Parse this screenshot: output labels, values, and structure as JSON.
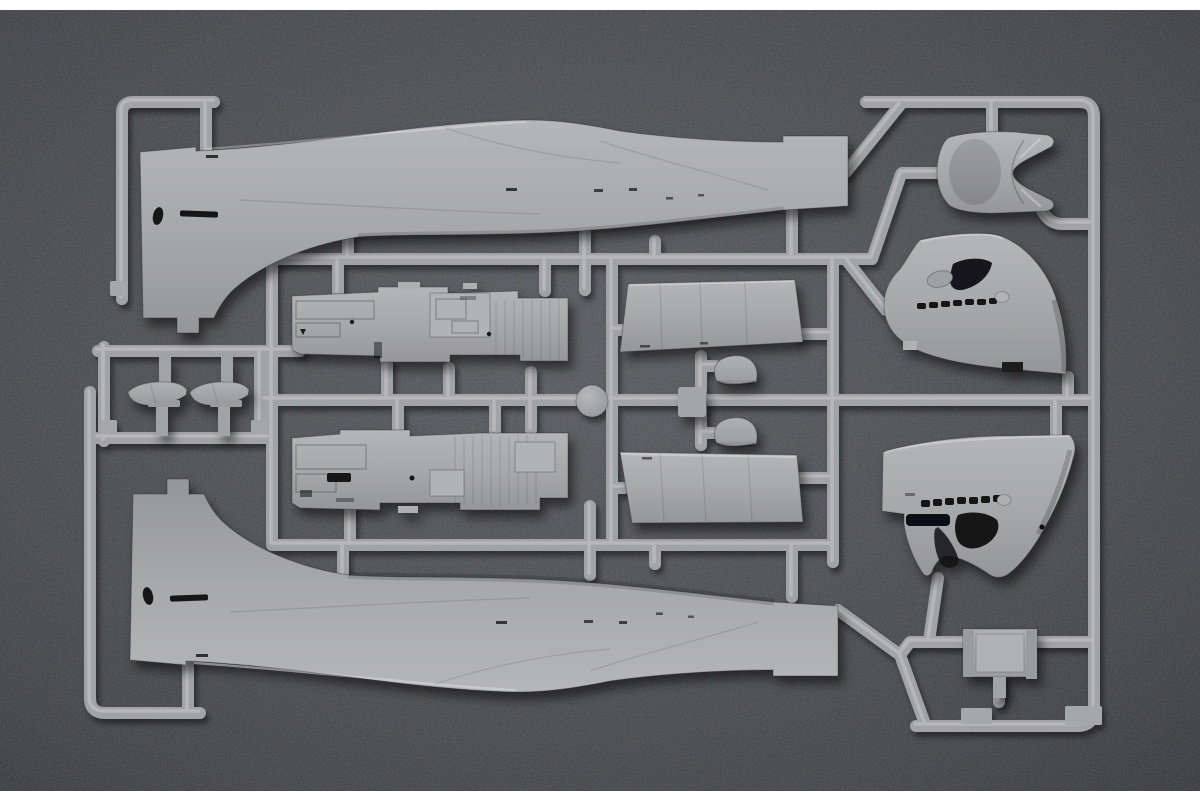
{
  "scene": {
    "description": "Macro product photograph of a grey injection-moulded plastic model aircraft sprue",
    "alt": "Light grey plastic model-kit sprue frame holding two large fuselage halves, two cockpit sidewall floor frames, two flap panels, two engine cowling side panels with rows of exhaust ports, a cowl-flap saddle section, two small intake fairings, two small seat fairings, an access hatch and a round moulding pad, photographed on a dark speckled grey surface with white strips at the top and bottom edges",
    "colors": {
      "backdrop": "#4b4c50",
      "backdrop_highlight": "#595a5f",
      "backdrop_shadow": "#38393d",
      "plastic": "#a6a7a9",
      "plastic_highlight": "#bdbec1",
      "plastic_shadow": "#8e8f92",
      "recess": "#151517",
      "border_strips": "#ffffff"
    },
    "border_strip_top_px": 10,
    "border_strip_bottom_px": 9
  },
  "parts": [
    {
      "id": "fuselage-half-upper",
      "label": "Fuselage half, left side"
    },
    {
      "id": "fuselage-half-lower",
      "label": "Fuselage half, right side"
    },
    {
      "id": "cockpit-sidewall-upper",
      "label": "Cockpit sidewall and floor frame"
    },
    {
      "id": "cockpit-sidewall-lower",
      "label": "Cockpit sidewall and floor frame, opposite side"
    },
    {
      "id": "flap-panel-upper",
      "label": "Flap panel"
    },
    {
      "id": "flap-panel-lower",
      "label": "Flap panel, opposite side"
    },
    {
      "id": "intake-fairing-upper",
      "label": "Intake fairing"
    },
    {
      "id": "intake-fairing-lower",
      "label": "Intake fairing, opposite side"
    },
    {
      "id": "cowling-side-upper",
      "label": "Engine cowling side panel with exhaust ports"
    },
    {
      "id": "cowling-side-lower",
      "label": "Engine cowling side panel with exhaust ports, opposite side"
    },
    {
      "id": "cowl-flap-saddle",
      "label": "Cowl flap saddle section"
    },
    {
      "id": "access-hatch",
      "label": "Access hatch"
    },
    {
      "id": "small-fairing-1",
      "label": "Small seat fairing"
    },
    {
      "id": "small-fairing-2",
      "label": "Small seat fairing, opposite side"
    },
    {
      "id": "sprue-frame",
      "label": "Sprue runner frame"
    },
    {
      "id": "mould-disc",
      "label": "Round moulding pad"
    }
  ]
}
